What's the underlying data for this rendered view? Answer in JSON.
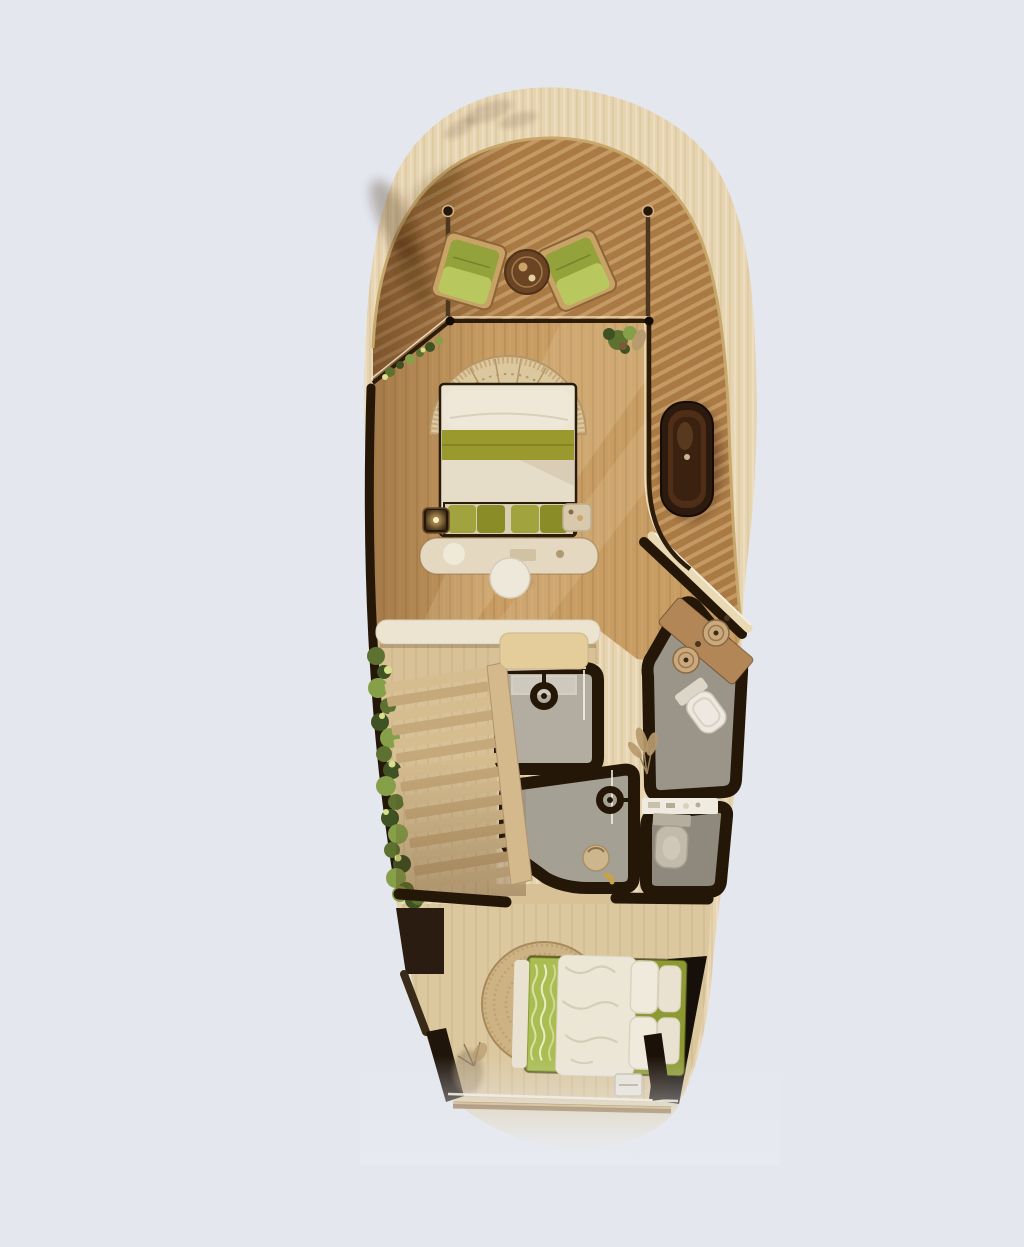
{
  "meta": {
    "title": "Top-down 3D rendered floor plan of a curved two-bedroom villa suite",
    "view": "top-down render, no visible text"
  },
  "colors": {
    "background": "#e4e7ee",
    "shell": "#e7d4b0",
    "shell_edge": "#c8a76b",
    "deck": "#aa7a44",
    "bedroom_floor": "#c89d63",
    "hall_floor": "#d8c196",
    "bedroom2_floor": "#dcc89f",
    "shower_a_floor": "#b3ada1",
    "shower_b_floor": "#a5a094",
    "wc_u_floor": "#9b9489",
    "wc_l_floor": "#8e887d",
    "wall": "#241708",
    "glass_frame": "#2c1c0c",
    "bench_white": "#ece4d0",
    "cushion_tan": "#e5cd9b",
    "toilet_white": "#eee9e0",
    "toilet_gray": "#c2bbac",
    "counter_wood": "#b28657",
    "sink_tan": "#caa97e",
    "tub_outer": "#2c1a0e",
    "tub_inner": "#4e2e16",
    "fan_rattan": "#dcc89e",
    "fan_line": "#b49768",
    "bed_white": "#ece5d4",
    "bed_green": "#99992e",
    "pillow_green": "#a1a33e",
    "pillow_green_dark": "#8a8c28",
    "chair_frame": "#c9a268",
    "chair_green": "#93a23b",
    "chair_green_light": "#b9c75f",
    "table_brown": "#6b4423",
    "console_cream": "#e4d8c0",
    "stool_cream": "#eee8da",
    "candle": "#ffd27e",
    "plant_dark": "#3f5224",
    "plant_mid": "#5d7230",
    "plant_light": "#86a04a",
    "plant_lit": "#d9e08c",
    "pampas": "#b79a6e",
    "rug": "#cdb384",
    "rug_ring": "#b19462",
    "bed2_green": "#8d9a33",
    "bed2_blanket": "#a9bd52",
    "duvet_white": "#ece6d6",
    "gold_bar": "#8a6636",
    "gold_hi": "#cfa963",
    "panel_dark": "#17100a"
  },
  "rooms": {
    "terrace": {
      "label": "Upper terrace deck with lounge chairs"
    },
    "bedroom1": {
      "label": "Main bedroom"
    },
    "bath_deck": {
      "label": "Side deck with outdoor bathtub"
    },
    "shower_a": {
      "label": "Shower room"
    },
    "shower_b": {
      "label": "Second shower room"
    },
    "wc_upper": {
      "label": "Vanity and toilet room"
    },
    "wc_lower": {
      "label": "Second toilet room"
    },
    "stairs": {
      "label": "Staircase with edge planter"
    },
    "bedroom2": {
      "label": "Lower bedroom"
    },
    "terrace2": {
      "label": "Lower terrace deck"
    }
  },
  "furniture": {
    "bed1": {
      "label": "Double bed with rattan fan headboard and green pillows"
    },
    "bed2": {
      "label": "Double bed with white duvet and green blanket"
    },
    "bathtub": {
      "label": "Freestanding dark stone bathtub"
    },
    "lounge_chairs": {
      "label": "Two olive-green lounge chairs"
    },
    "side_table": {
      "label": "Round dark wood side table"
    },
    "vanity": {
      "label": "Wood vanity with two round vessel sinks"
    },
    "rug": {
      "label": "Round woven jute rug"
    },
    "bench": {
      "label": "Window bench seat"
    },
    "console": {
      "label": "Curved console behind bed"
    },
    "stool": {
      "label": "Round cream stool"
    }
  }
}
